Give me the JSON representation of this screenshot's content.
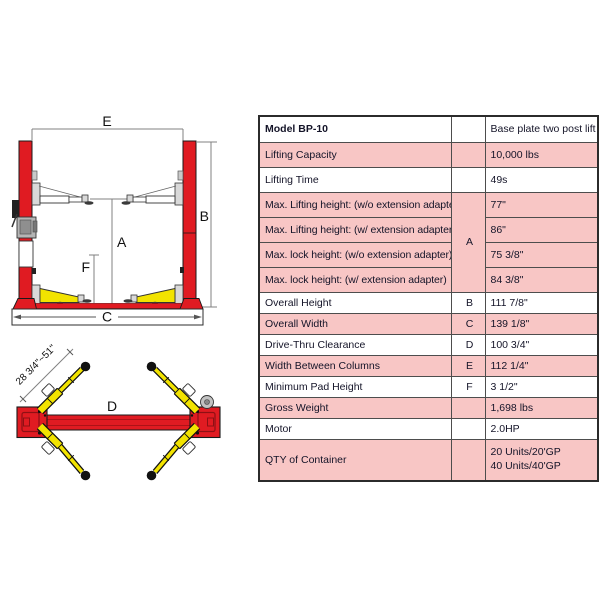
{
  "diagram": {
    "front_view": {
      "label_e": "E",
      "label_b": "B",
      "label_a": "A",
      "label_f": "F",
      "label_c": "C"
    },
    "top_view": {
      "label_d": "D",
      "arm_reach_range": "28 3/4\"~51\""
    },
    "colors": {
      "post_red": "#e01b22",
      "arm_yellow": "#f2e300",
      "table_pink": "#f8c6c5"
    }
  },
  "table": {
    "header": {
      "label": "Model BP-10",
      "letter": "",
      "value": "Base plate two post lift"
    },
    "rows": [
      {
        "label": "Lifting Capacity",
        "letter": "",
        "value": "10,000 lbs",
        "shaded": true
      },
      {
        "label": "Lifting Time",
        "letter": "",
        "value": "49s",
        "shaded": false
      },
      {
        "label": "Max. Lifting height: (w/o extension adapter)",
        "letter": "A",
        "value": "77\"",
        "shaded": true
      },
      {
        "label": "Max. Lifting height: (w/ extension adapter)",
        "value": "86\"",
        "shaded": true
      },
      {
        "label": "Max. lock height: (w/o extension adapter)",
        "value": "75 3/8\"",
        "shaded": true
      },
      {
        "label": "Max. lock height: (w/ extension adapter)",
        "value": "84 3/8\"",
        "shaded": true
      },
      {
        "label": "Overall Height",
        "letter": "B",
        "value": "111 7/8\"",
        "shaded": false
      },
      {
        "label": "Overall Width",
        "letter": "C",
        "value": "139 1/8\"",
        "shaded": true
      },
      {
        "label": "Drive-Thru Clearance",
        "letter": "D",
        "value": "100 3/4\"",
        "shaded": false
      },
      {
        "label": "Width Between Columns",
        "letter": "E",
        "value": "112 1/4\"",
        "shaded": true
      },
      {
        "label": "Minimum Pad Height",
        "letter": "F",
        "value": "3 1/2\"",
        "shaded": false
      },
      {
        "label": "Gross Weight",
        "letter": "",
        "value": "1,698 lbs",
        "shaded": true
      },
      {
        "label": "Motor",
        "letter": "",
        "value": "2.0HP",
        "shaded": false
      },
      {
        "label": "QTY of Container",
        "letter": "",
        "value": "20 Units/20'GP\n40 Units/40'GP",
        "shaded": true
      }
    ]
  }
}
